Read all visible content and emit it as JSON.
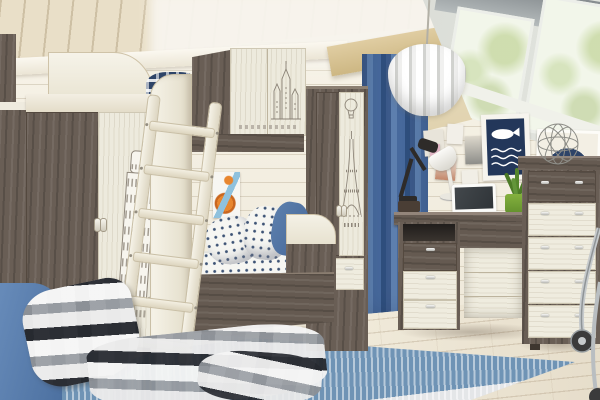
{
  "scene": {
    "description": "Furniture catalog photograph of a children's attic bedroom with a travel-sketch themed furniture set",
    "room": {
      "wall": "white horizontal plank paneling",
      "ceiling": "cream wood plank ceiling",
      "floor": "light oak laminate",
      "beam": "tan wooden beam",
      "window": "slanted attic skylight with two panes and trees outside",
      "curtain": "blue drape",
      "pendant_lamp": "white slatted drum pendant"
    },
    "furniture": {
      "wardrobe_left": {
        "label": "Two-door wardrobe, dark ash side and white door with Leaning Tower of Pisa sketch",
        "print": "pisa-tower"
      },
      "bunk_bed": {
        "label": "Loft bunk bed with white ladder and overhead cabinet",
        "cabinet_print": "castle-sketch",
        "bedding": "blue polka-dot sheets and pillows, navy plaid on top bunk"
      },
      "tall_wardrobe": {
        "label": "Narrow two-door wardrobe with bottom drawer",
        "prints": [
          "hot-air-balloon",
          "eiffel-tower"
        ]
      },
      "desk": {
        "label": "Writing desk with drawer pedestal",
        "items": [
          "black task lamp",
          "white task lamp",
          "white monitor",
          "green potted plant",
          "wooden box"
        ]
      },
      "dresser": {
        "label": "Five-drawer chest, dark top drawer and white lower drawers",
        "decor": "wire sphere ornament"
      },
      "chair": {
        "label": "Chrome office chair fragment"
      },
      "armchair": {
        "label": "Blue armchair corner with checked plaid blanket"
      }
    },
    "decor": {
      "posters": [
        "navy whale poster",
        "target roundel poster",
        "orange rocket print",
        "pinned photos and postcards"
      ],
      "rug": "abstract blue-rust-grey rug",
      "blanket": "black-white-grey checked plaid"
    },
    "palette": {
      "dark_wood": "#695e55",
      "light_wood": "#edeadd",
      "wall": "#f3eee2",
      "floor": "#ece5d6",
      "curtain_blue": "#47699c",
      "denim_blue": "#5b80b0",
      "poster_navy": "#23375a",
      "accent_red": "#c23c34",
      "rug_rust": "#b96a4e",
      "beam_tan": "#d2bd90"
    }
  }
}
